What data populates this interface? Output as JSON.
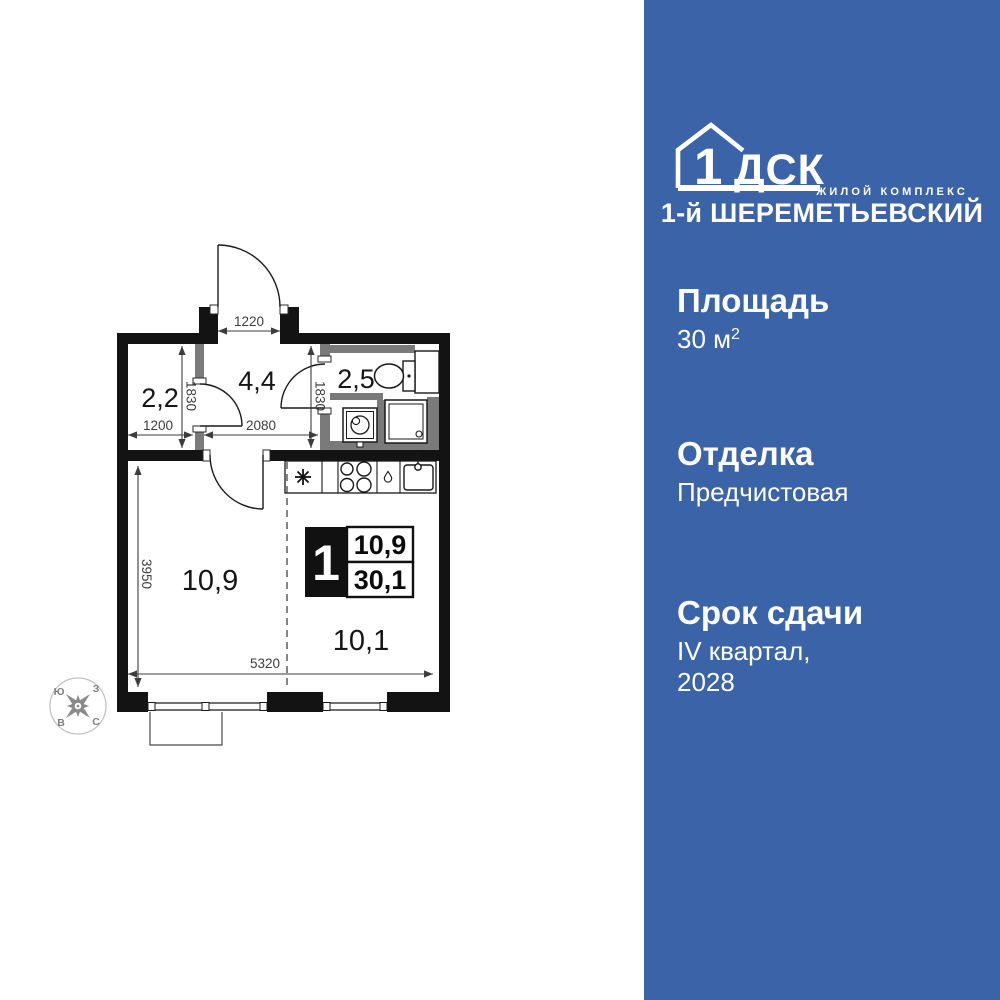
{
  "sidebar": {
    "panel_color": "#3A63A8",
    "logo": {
      "one": "1",
      "dsk": "ДСК",
      "tagline": "ЖИЛОЙ КОМПЛЕКС",
      "title": "1-й ШЕРЕМЕТЬЕВСКИЙ"
    },
    "area": {
      "label": "Площадь",
      "value": "30 м",
      "sup": "2"
    },
    "finish": {
      "label": "Отделка",
      "value": "Предчистовая"
    },
    "deadline": {
      "label": "Срок сдачи",
      "value": "IV квартал,",
      "value2": "2028"
    }
  },
  "plan": {
    "rooms": {
      "hall_small": "2,2",
      "hall": "4,4",
      "bath": "2,5",
      "living": "10,9",
      "kitchen": "10,1"
    },
    "dims": {
      "entrance": "1220",
      "left_width": "1200",
      "hall_width": "2080",
      "left_height": "1830",
      "hall_height": "1830",
      "living_height": "3950",
      "living_width": "5320"
    },
    "badge": {
      "rooms_count": "1",
      "living_area": "10,9",
      "total_area": "30,1"
    },
    "compass": {
      "nw": "Ю",
      "ne": "З",
      "sw": "В",
      "se": "С"
    }
  }
}
